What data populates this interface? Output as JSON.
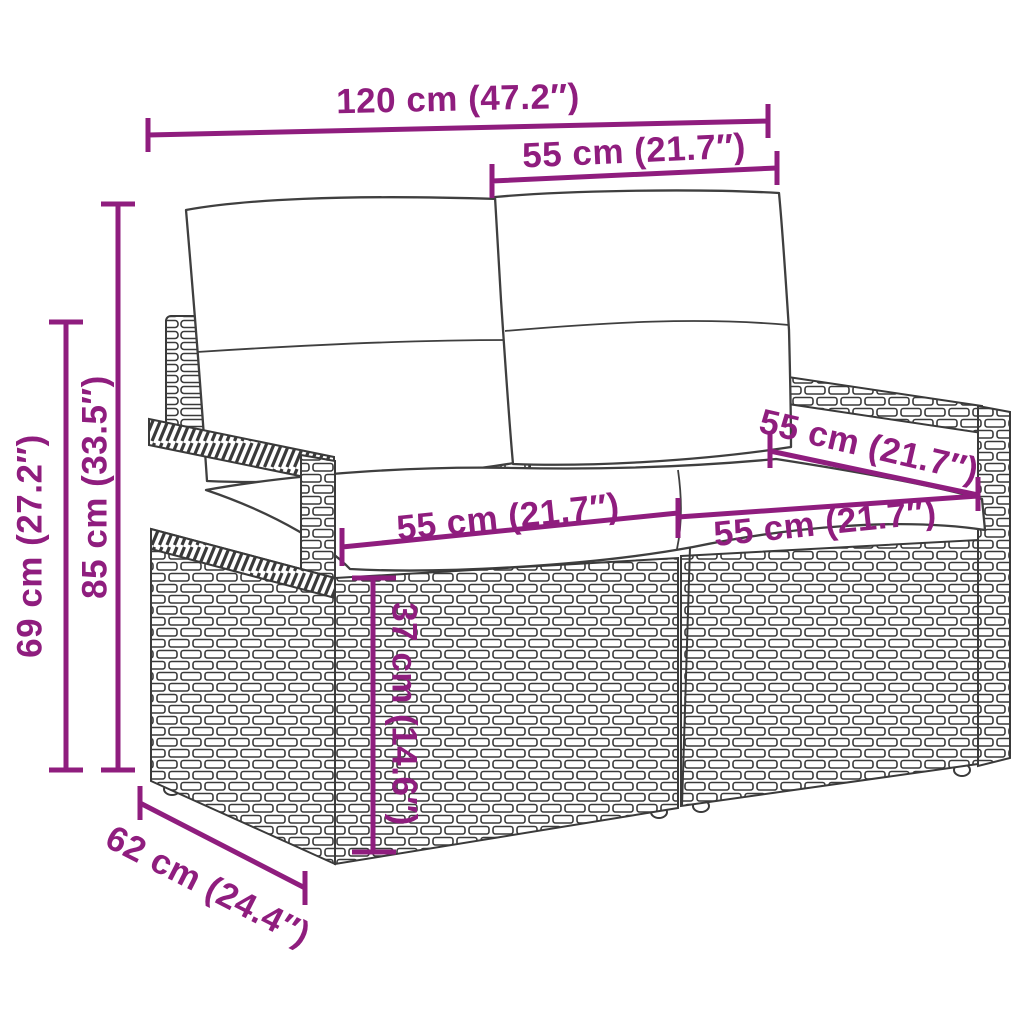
{
  "diagram": {
    "type": "product-dimension-diagram",
    "subject": "poly rattan 2-seater garden sofa with cushions",
    "background_color": "#ffffff",
    "dimension_color": "#8F1D7E",
    "line_art_color": "#3a3a3a"
  },
  "dimensions": {
    "overall_width": "120 cm (47.2″)",
    "upper_seat_width": "55 cm (21.7″)",
    "total_height": "85 cm (33.5″)",
    "arm_height": "69 cm (27.2″)",
    "left_seat_width": "55 cm (21.7″)",
    "right_seat_width": "55 cm (21.7″)",
    "seat_depth": "55 cm (21.7″)",
    "seat_height": "37 cm (14.6″)",
    "depth": "62 cm (24.4″)"
  }
}
